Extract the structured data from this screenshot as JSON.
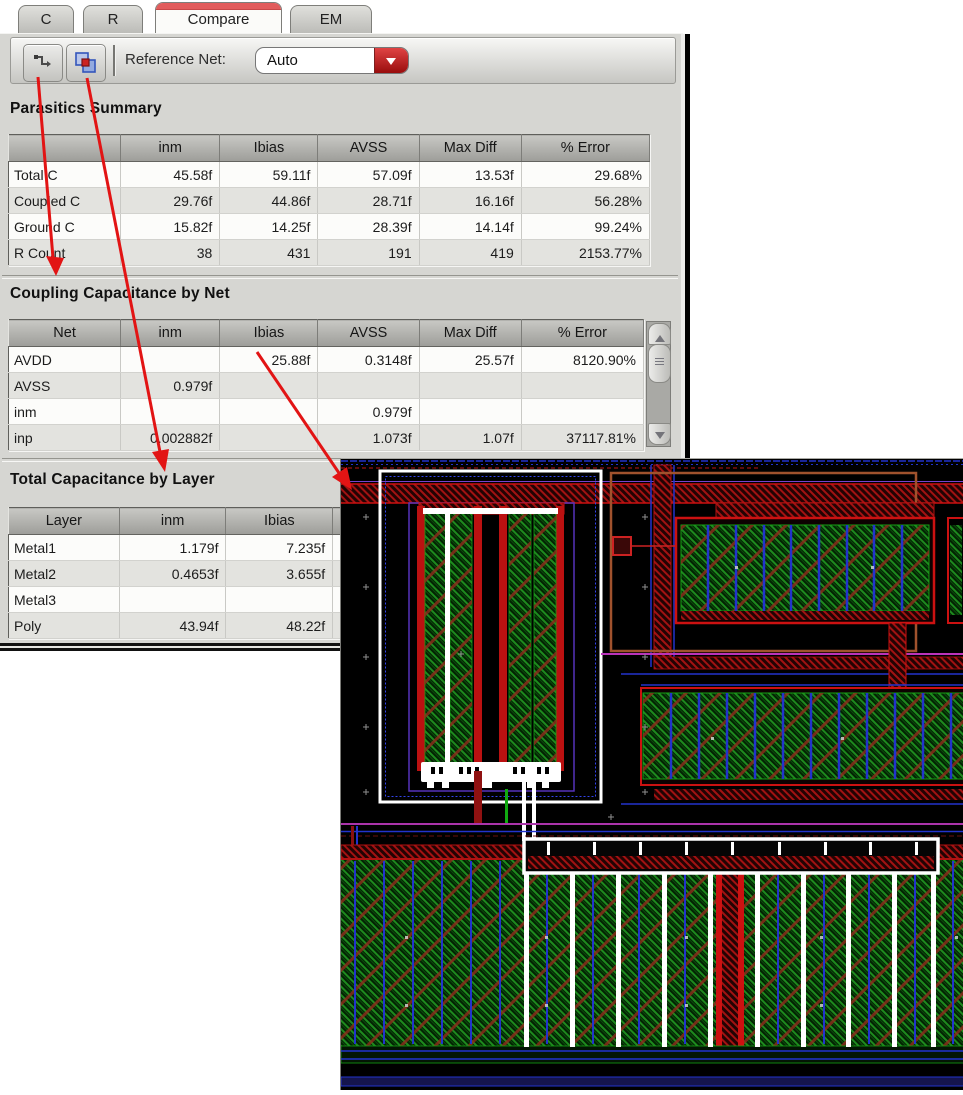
{
  "tabs": [
    {
      "label": "C",
      "active": false
    },
    {
      "label": "R",
      "active": false
    },
    {
      "label": "Compare",
      "active": true
    },
    {
      "label": "EM",
      "active": false
    }
  ],
  "toolbar": {
    "icons": [
      {
        "name": "net-trace-icon"
      },
      {
        "name": "overlap-compare-icon"
      }
    ],
    "reference_net_label": "Reference Net:",
    "reference_net_value": "Auto"
  },
  "sections": {
    "parasitics_summary": {
      "title": "Parasitics Summary",
      "headers": [
        "",
        "inm",
        "Ibias",
        "AVSS",
        "Max Diff",
        "% Error"
      ],
      "rows": [
        [
          "Total C",
          "45.58f",
          "59.11f",
          "57.09f",
          "13.53f",
          "29.68%"
        ],
        [
          "Coupled C",
          "29.76f",
          "44.86f",
          "28.71f",
          "16.16f",
          "56.28%"
        ],
        [
          "Ground C",
          "15.82f",
          "14.25f",
          "28.39f",
          "14.14f",
          "99.24%"
        ],
        [
          "R Count",
          "38",
          "431",
          "191",
          "419",
          "2153.77%"
        ]
      ]
    },
    "coupling_by_net": {
      "title": "Coupling Capacitance by Net",
      "headers": [
        "Net",
        "inm",
        "Ibias",
        "AVSS",
        "Max Diff",
        "% Error"
      ],
      "rows": [
        [
          "AVDD",
          "",
          "25.88f",
          "0.3148f",
          "25.57f",
          "8120.90%"
        ],
        [
          "AVSS",
          "0.979f",
          "",
          "",
          "",
          ""
        ],
        [
          "inm",
          "",
          "",
          "0.979f",
          "",
          ""
        ],
        [
          "inp",
          "0.002882f",
          "",
          "1.073f",
          "1.07f",
          "37117.81%"
        ]
      ]
    },
    "total_by_layer": {
      "title": "Total Capacitance by Layer",
      "headers": [
        "Layer",
        "inm",
        "Ibias",
        ""
      ],
      "rows": [
        [
          "Metal1",
          "1.179f",
          "7.235f",
          ""
        ],
        [
          "Metal2",
          "0.4653f",
          "3.655f",
          ""
        ],
        [
          "Metal3",
          "",
          "",
          ""
        ],
        [
          "Poly",
          "43.94f",
          "48.22f",
          ""
        ]
      ]
    }
  },
  "scrollbar": {
    "name": "coupling-table-scrollbar"
  },
  "annotations": {
    "arrow_color": "#e21414",
    "arrows": [
      {
        "from": "net-trace-button",
        "to": "coupling-by-net-section"
      },
      {
        "from": "overlap-compare-button",
        "to": "total-by-layer-section"
      },
      {
        "from": "coupling-cell-avdd-ibias",
        "to": "layout-highlighted-cell"
      }
    ]
  },
  "layout_view": {
    "description": "IC layout canvas with highlighted (white) net geometry",
    "colors": {
      "background": "#000000",
      "poly_green": "#1e8a1e",
      "metal_red": "#c21414",
      "metal_blue": "#2233cc",
      "boundary_purple": "#5533bb",
      "magenta_rail": "#b333b3",
      "well_brown": "#a0522d",
      "highlight_white": "#ffffff"
    }
  }
}
